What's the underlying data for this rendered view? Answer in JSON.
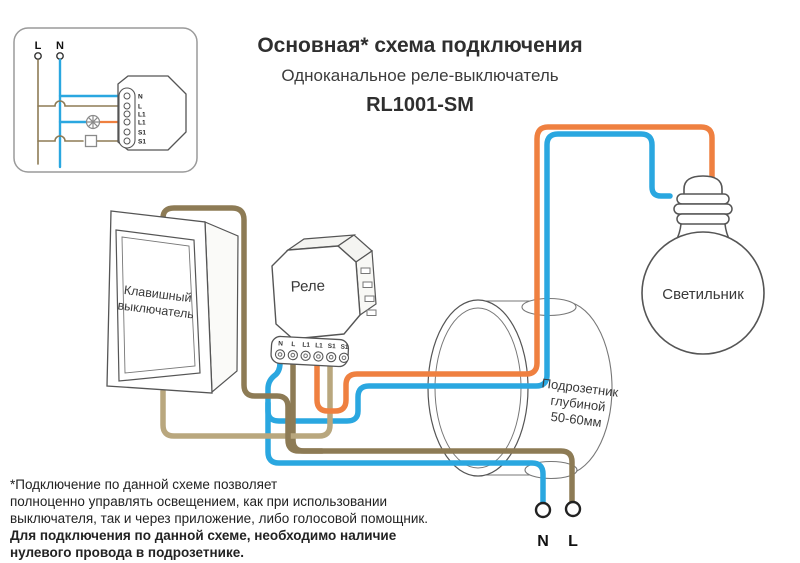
{
  "header": {
    "title": "Основная* схема подключения",
    "subtitle": "Одноканальное реле-выключатель",
    "model": "RL1001-SM"
  },
  "inset": {
    "l_label": "L",
    "n_label": "N",
    "terminals": [
      "N",
      "L",
      "L1",
      "L1",
      "S1",
      "S1"
    ]
  },
  "relay": {
    "label": "Реле",
    "terminals": [
      "N",
      "L",
      "L1",
      "L1",
      "S1",
      "S1"
    ]
  },
  "switch": {
    "line1": "Клавишный",
    "line2": "выключатель"
  },
  "backbox": {
    "line1": "Подрозетник",
    "line2": "глубиной",
    "line3": "50-60мм"
  },
  "bulb": {
    "label": "Светильник"
  },
  "supply": {
    "n_label": "N",
    "l_label": "L"
  },
  "footnote": {
    "lines": [
      "*Подключение по данной схеме позволяет",
      "полноценно управлять освещением, как при использовании",
      "выключателя, так и через приложение, либо голосовой помощник.",
      "Для подключения по данной схеме, необходимо наличие",
      "нулевого провода в подрозетнике."
    ]
  },
  "colors": {
    "blue": "#2aa7e0",
    "orange": "#ef8040",
    "khaki_dark": "#8d7b55",
    "khaki_light": "#b9a77e",
    "outline": "#555555",
    "thin": "#777777"
  }
}
